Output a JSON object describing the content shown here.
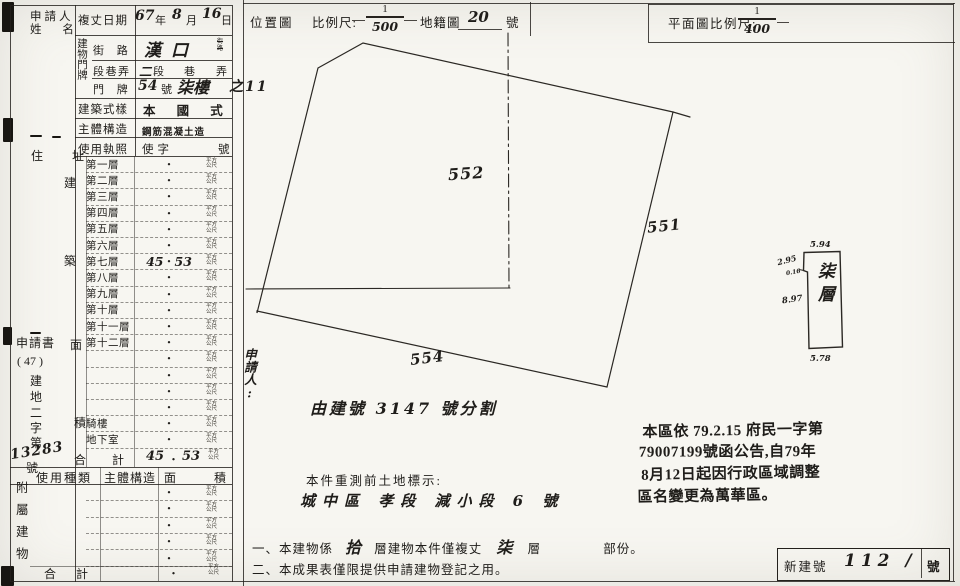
{
  "ink": "#1f1d1a",
  "dot": "・",
  "table": {
    "applicant": {
      "line1": "申請人",
      "line2": "姓  名"
    },
    "survey": {
      "label": "複丈日期",
      "y": "67",
      "yu": "年",
      "m": "8",
      "mu": "月",
      "d": "16",
      "du": "日"
    },
    "door_group": "建物門牌",
    "street": {
      "label": "街 路",
      "value": "漢口",
      "tiny1": "街",
      "tiny2": "路"
    },
    "section": {
      "label": "段巷弄",
      "hand": "二",
      "seg": "段",
      "lane": "巷",
      "alley": "弄"
    },
    "door": {
      "label": "門 牌",
      "no": "54",
      "no_unit": "號",
      "floor": "柒樓",
      "extra": "之11"
    },
    "style": {
      "label": "建築式樣",
      "value": "本 國 式"
    },
    "structure": {
      "label": "主體構造",
      "value": "鋼筋混凝土造"
    },
    "license": {
      "label": "使用執照",
      "value": "使字",
      "unit": "號"
    },
    "residence": "住  址",
    "side_chars": [
      "建",
      "築",
      "面",
      "積"
    ],
    "unit_top": "平方",
    "unit_bottom": "公尺",
    "rows": [
      {
        "label": "第一層",
        "l": "",
        "r": ""
      },
      {
        "label": "第二層",
        "l": "",
        "r": ""
      },
      {
        "label": "第三層",
        "l": "",
        "r": ""
      },
      {
        "label": "第四層",
        "l": "",
        "r": ""
      },
      {
        "label": "第五層",
        "l": "",
        "r": ""
      },
      {
        "label": "第六層",
        "l": "",
        "r": ""
      },
      {
        "label": "第七層",
        "l": "45",
        "r": "53"
      },
      {
        "label": "第八層",
        "l": "",
        "r": ""
      },
      {
        "label": "第九層",
        "l": "",
        "r": ""
      },
      {
        "label": "第十層",
        "l": "",
        "r": ""
      },
      {
        "label": "第十一層",
        "l": "",
        "r": ""
      },
      {
        "label": "第十二層",
        "l": "",
        "r": ""
      },
      {
        "label": "",
        "l": "",
        "r": ""
      },
      {
        "label": "",
        "l": "",
        "r": ""
      },
      {
        "label": "",
        "l": "",
        "r": ""
      },
      {
        "label": "",
        "l": "",
        "r": ""
      },
      {
        "label": "騎樓",
        "l": "",
        "r": ""
      },
      {
        "label": "地下室",
        "l": "",
        "r": ""
      }
    ],
    "total": {
      "label_a": "合",
      "label_b": "計",
      "l": "45",
      "r": "53"
    },
    "app_no": {
      "title": "申請書",
      "paren": "( 47 )",
      "chars": [
        "建",
        "地",
        "二",
        "字",
        "第"
      ],
      "number": "13283",
      "suffix": "號"
    },
    "usage_header": {
      "a": "使用種類",
      "b": "主體構造",
      "c": "面",
      "d": "積"
    },
    "annex_chars": [
      "附",
      "屬",
      "建",
      "物"
    ],
    "annex_rows": [
      "",
      "",
      "",
      "",
      ""
    ],
    "annex_total_a": "合",
    "annex_total_b": "計"
  },
  "loc": {
    "title": "位置圖",
    "scale": "比例尺:",
    "num": "1",
    "den": "500",
    "cad": "地籍圖",
    "cad_no": "20",
    "cad_unit": "號",
    "p552": "552",
    "p551": "551",
    "p554": "554",
    "applicant_vert": "申請人:",
    "division": "由建號 3147 號分割",
    "presurvey_label": "本件重測前土地標示:",
    "presurvey_value": "城中區 孝段 減小段 6 號"
  },
  "plan": {
    "title": "平面圖比例尺:",
    "num": "1",
    "den": "400",
    "floor": "柒層",
    "dim_top": "5.94",
    "dim_left_top": "2.95",
    "dim_notch": "0.16",
    "dim_left": "8.97",
    "dim_bottom": "5.78"
  },
  "stamp": {
    "l1": "本區依 79.2.15 府民一字第",
    "l2": "79007199號函公告,自79年",
    "l3": "8月12日起因行政區域調整",
    "l4": "區名變更為萬華區。"
  },
  "notes": {
    "n1a": "一、本建物係",
    "h1": "拾",
    "n1b": "層建物本件僅複丈",
    "h2": "柒",
    "n1c": "層",
    "n1d": "部份。",
    "n2": "二、本成果表僅限提供申請建物登記之用。"
  },
  "newno": {
    "label": "新建號",
    "value": "112 /",
    "unit": "號"
  }
}
